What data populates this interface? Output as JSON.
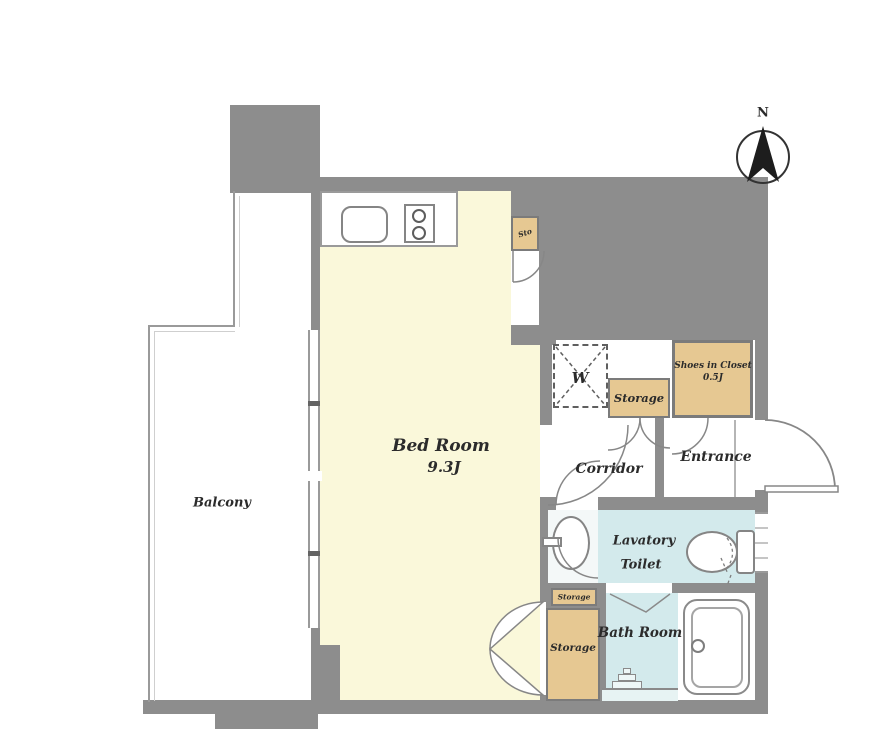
{
  "title": "Apartment floor plan",
  "compass": {
    "north_label": "N"
  },
  "rooms": {
    "balcony": {
      "label": "Balcony"
    },
    "bedroom": {
      "label": "Bed Room",
      "size": "9.3J"
    },
    "corridor": {
      "label": "Corridor"
    },
    "entrance": {
      "label": "Entrance"
    },
    "shoes_closet": {
      "label": "Shoes in Closet",
      "size": "0.5J"
    },
    "lavatory_toilet": {
      "line1": "Lavatory",
      "line2": "Toilet"
    },
    "bath_room": {
      "label": "Bath Room"
    },
    "storage_hall_box": {
      "label": "Storage"
    },
    "storage_room": {
      "label": "Storage"
    },
    "storage_small_box": {
      "label": "Storage"
    },
    "storage_mini_box": {
      "label": "Sto"
    },
    "washer_area": {
      "label": "W"
    }
  },
  "colors": {
    "wall": "#8d8d8d",
    "bedroom_floor": "#faf8da",
    "closet_fill": "#e6c892",
    "wet_area_fill": "#d3eaec",
    "background": "#ffffff"
  }
}
